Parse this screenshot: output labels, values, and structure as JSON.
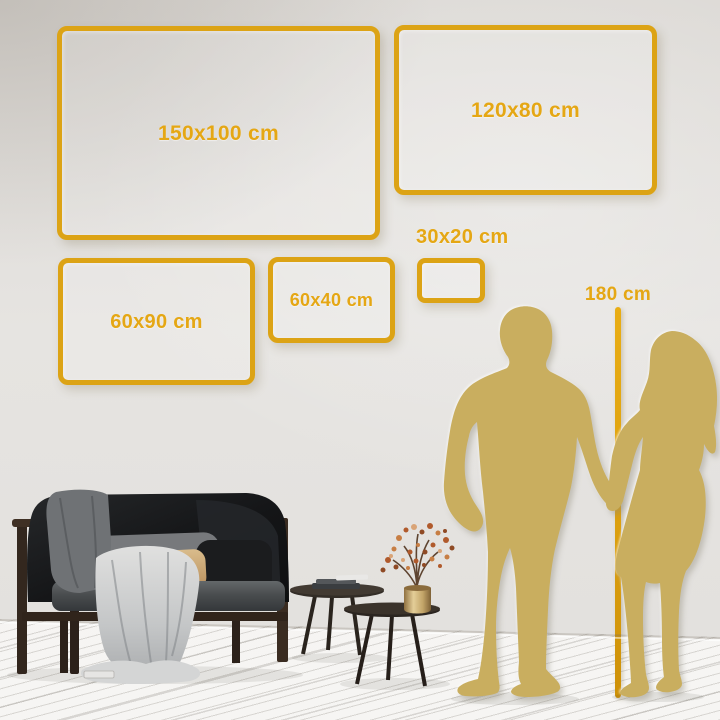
{
  "frames": [
    {
      "label": "150x100 cm",
      "cm": [
        150,
        100
      ]
    },
    {
      "label": "120x80 cm",
      "cm": [
        120,
        80
      ]
    },
    {
      "label": "60x90 cm",
      "cm": [
        60,
        90
      ]
    },
    {
      "label": "60x40 cm",
      "cm": [
        60,
        40
      ]
    },
    {
      "label": "30x20 cm",
      "cm": [
        30,
        20
      ]
    }
  ],
  "height_marker": {
    "label": "180 cm",
    "cm": 180
  },
  "silhouettes": [
    {
      "name": "man"
    },
    {
      "name": "woman"
    }
  ],
  "colors": {
    "frame_gold": "#DCA315",
    "label_gold": "#E5A714",
    "ruler_gold": "#DCA00F",
    "silhouette_gold": "#C9AE5F",
    "wall": "#E2E0DD",
    "floor": "#F4F3F1"
  }
}
